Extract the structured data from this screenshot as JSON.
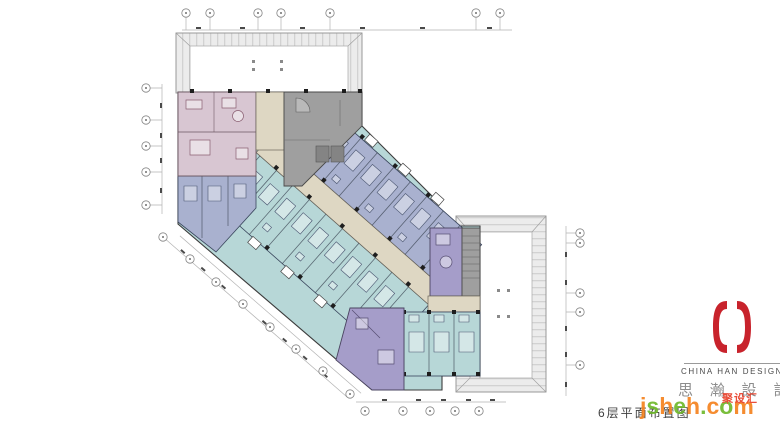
{
  "caption": {
    "text": "6层平面布置图"
  },
  "brand": {
    "name_en": "CHINA HAN DESIGN",
    "name_cn": "思 瀚 設 計",
    "mark_color": "#c8232c"
  },
  "watermark": {
    "site": "jsheh.com",
    "badge": "聚设汇",
    "letter_colors": [
      "#f5831f",
      "#6fb92c"
    ],
    "badge_color": "#e8402a"
  },
  "plan": {
    "type": "hotel-floor-plan",
    "floor_label": "6层",
    "zones": [
      {
        "name": "suite-rooms",
        "color": "#d8c6d2"
      },
      {
        "name": "guest-rooms-north",
        "color": "#a9b1cf"
      },
      {
        "name": "guest-rooms-south",
        "color": "#b7d7d7"
      },
      {
        "name": "corner-suites",
        "color": "#a59dc9"
      },
      {
        "name": "service-core",
        "color": "#9f9f9f"
      },
      {
        "name": "corridor",
        "color": "#ded7c3"
      },
      {
        "name": "atrium-roof",
        "color": "#ffffff"
      }
    ],
    "annotation_color": "#9a9a9a"
  }
}
